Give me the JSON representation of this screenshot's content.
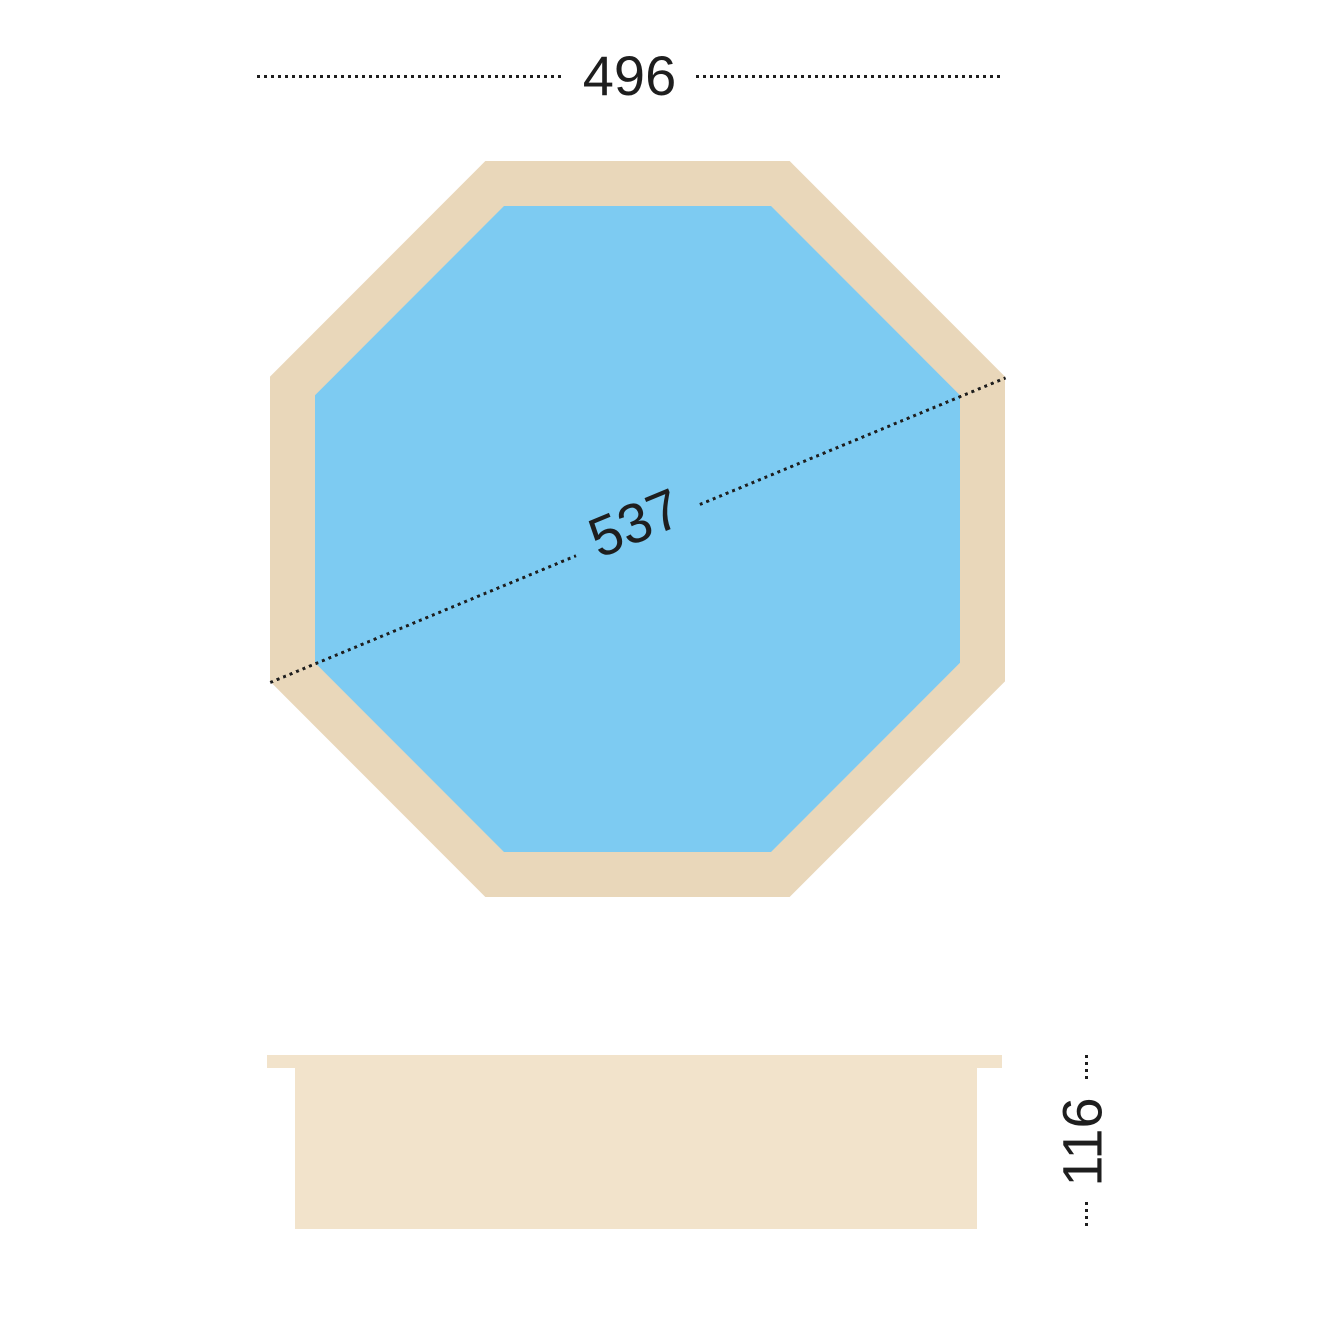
{
  "diagram": {
    "kind": "octagonal-pool-dimension-drawing",
    "plan_view": {
      "shape": "regular-octagon",
      "outer_ring": "wood-frame",
      "inner_fill": "water"
    },
    "side_view": {
      "shape": "wall-profile-with-top-rim"
    },
    "dimensions": {
      "outer_width": {
        "value": "496",
        "placement": "top-horizontal-across-flats"
      },
      "diagonal": {
        "value": "537",
        "placement": "across-opposite-vertices"
      },
      "wall_height": {
        "value": "116",
        "placement": "right-vertical-side-view"
      }
    }
  },
  "colors": {
    "background": "#ffffff",
    "frame": "#e9d7ba",
    "water": "#7dcbf2",
    "side_body": "#f2e3cb",
    "ink": "#1e1e1e"
  }
}
